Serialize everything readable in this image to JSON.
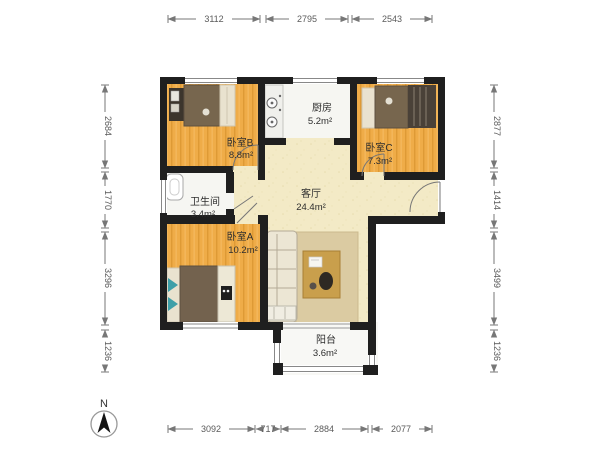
{
  "plan": {
    "title": "apartment-floorplan",
    "rooms": [
      {
        "id": "bedroomB",
        "label": "卧室B",
        "area": "8.8m²"
      },
      {
        "id": "kitchen",
        "label": "厨房",
        "area": "5.2m²"
      },
      {
        "id": "bedroomC",
        "label": "卧室C",
        "area": "7.3m²"
      },
      {
        "id": "bathroom",
        "label": "卫生间",
        "area": "3.4m²"
      },
      {
        "id": "living",
        "label": "客厅",
        "area": "24.4m²"
      },
      {
        "id": "bedroomA",
        "label": "卧室A",
        "area": "10.2m²"
      },
      {
        "id": "balcony",
        "label": "阳台",
        "area": "3.6m²"
      }
    ],
    "dimensions": {
      "top": [
        "3112",
        "2795",
        "2543"
      ],
      "bottom": [
        "3092",
        "717",
        "2884",
        "2077"
      ],
      "left": [
        "2684",
        "1770",
        "3296",
        "1236"
      ],
      "right": [
        "2877",
        "1414",
        "3499",
        "1236"
      ]
    },
    "compass": {
      "label": "N"
    },
    "colors": {
      "wall": "#1f1f1f",
      "wood_floor": "#efac48",
      "living_floor": "#f3eac6",
      "tile_floor": "#f6f6f2",
      "bed_duvet": "#77664e",
      "accent_teal": "#3e9fa8",
      "rug": "#dbcba2",
      "table": "#c99f4c",
      "dim_text": "#5a5a5a"
    }
  }
}
